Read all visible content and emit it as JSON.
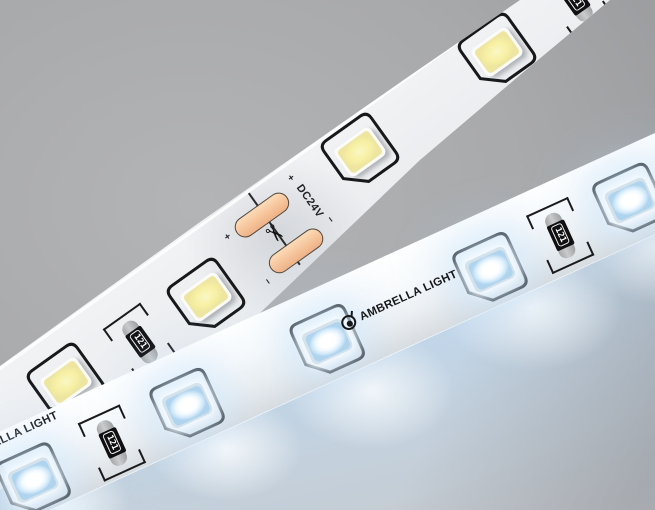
{
  "upper_strip": {
    "voltage_label": "DC24V",
    "polarity_positive": "+",
    "polarity_negative": "−",
    "resistor_code": "121",
    "scissors_icon": "✂"
  },
  "lower_strip": {
    "brand_text": "AMBRELLA LIGHT",
    "resistor_code": "121"
  },
  "colors": {
    "background_gray": "#a4a5a8",
    "strip_white": "#f3f4f6",
    "warm_led_yellow": "#f6f0a6",
    "cool_led_white": "#ffffff",
    "glow_panel_blue": "#c6dcf0",
    "solder_pad_copper": "#f6c59c",
    "silkscreen_black": "#1b1b1d"
  }
}
